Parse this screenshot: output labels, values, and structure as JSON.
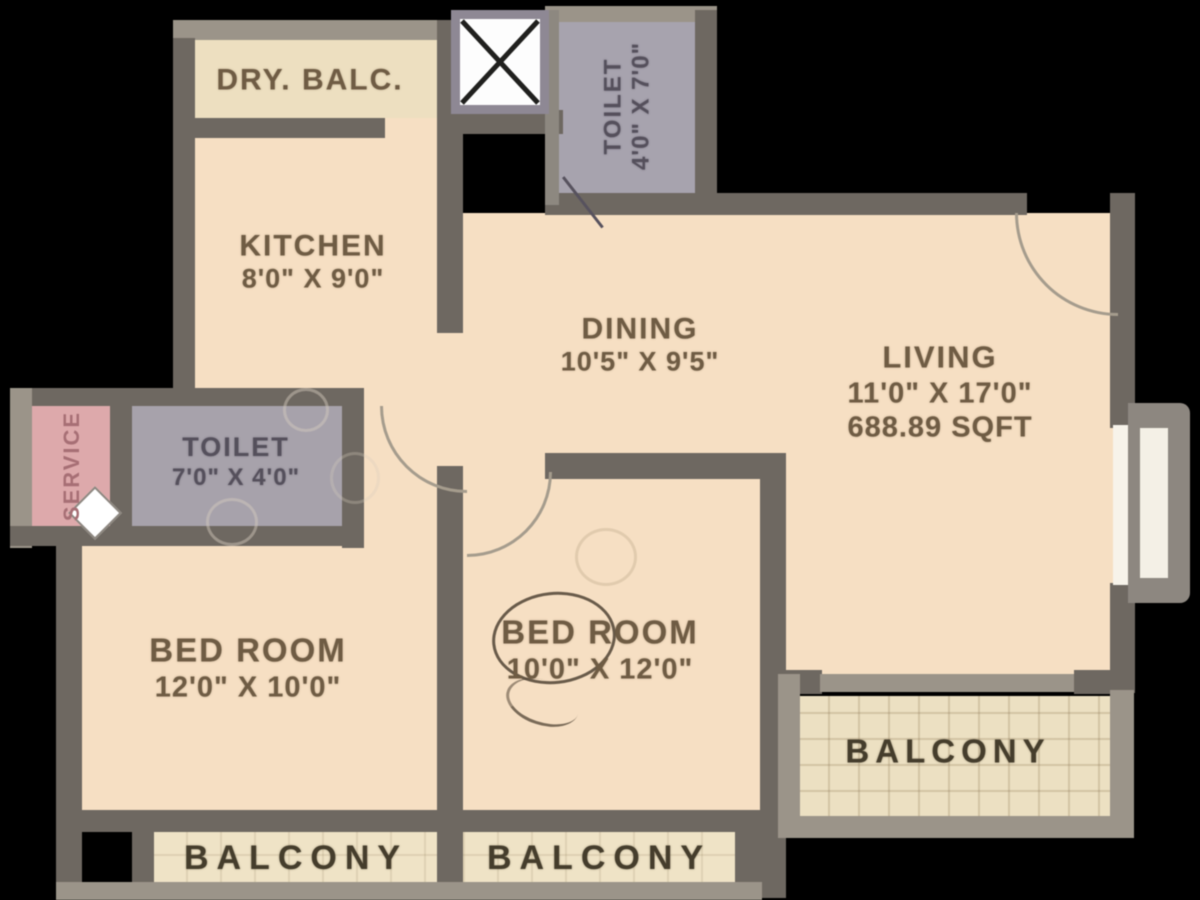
{
  "title": "2BHK apartment floor plan",
  "colors": {
    "background": "#000000",
    "wall_dark": "#6e6861",
    "wall_light": "#9b9489",
    "floor_peach": "#f6dfc3",
    "toilet_gray": "#a7a2ab",
    "service_pink": "#dda9ab",
    "balcony_cream": "#ece0c2"
  },
  "rooms": {
    "dry_balc": {
      "label": "DRY. BALC."
    },
    "toilet_top": {
      "label": "TOILET",
      "dims": "4'0\" X 7'0\""
    },
    "kitchen": {
      "label": "KITCHEN",
      "dims": "8'0\" X 9'0\""
    },
    "dining": {
      "label": "DINING",
      "dims": "10'5\" X 9'5\""
    },
    "living": {
      "label": "LIVING",
      "dims": "11'0\" X 17'0\"",
      "area": "688.89 SQFT"
    },
    "service": {
      "label": "SERVICE"
    },
    "toilet_left": {
      "label": "TOILET",
      "dims": "7'0\" X 4'0\""
    },
    "bedroom_left": {
      "label": "BED ROOM",
      "dims": "12'0\" X 10'0\""
    },
    "bedroom_center": {
      "label": "BED ROOM",
      "dims": "10'0\" X 12'0\""
    },
    "balcony_left": {
      "label": "BALCONY"
    },
    "balcony_center": {
      "label": "BALCONY"
    },
    "balcony_right": {
      "label": "BALCONY"
    }
  },
  "icons": {
    "shaft_cross": "duct-shaft-x",
    "door_swings": 3,
    "entrance_door_side": "right"
  }
}
